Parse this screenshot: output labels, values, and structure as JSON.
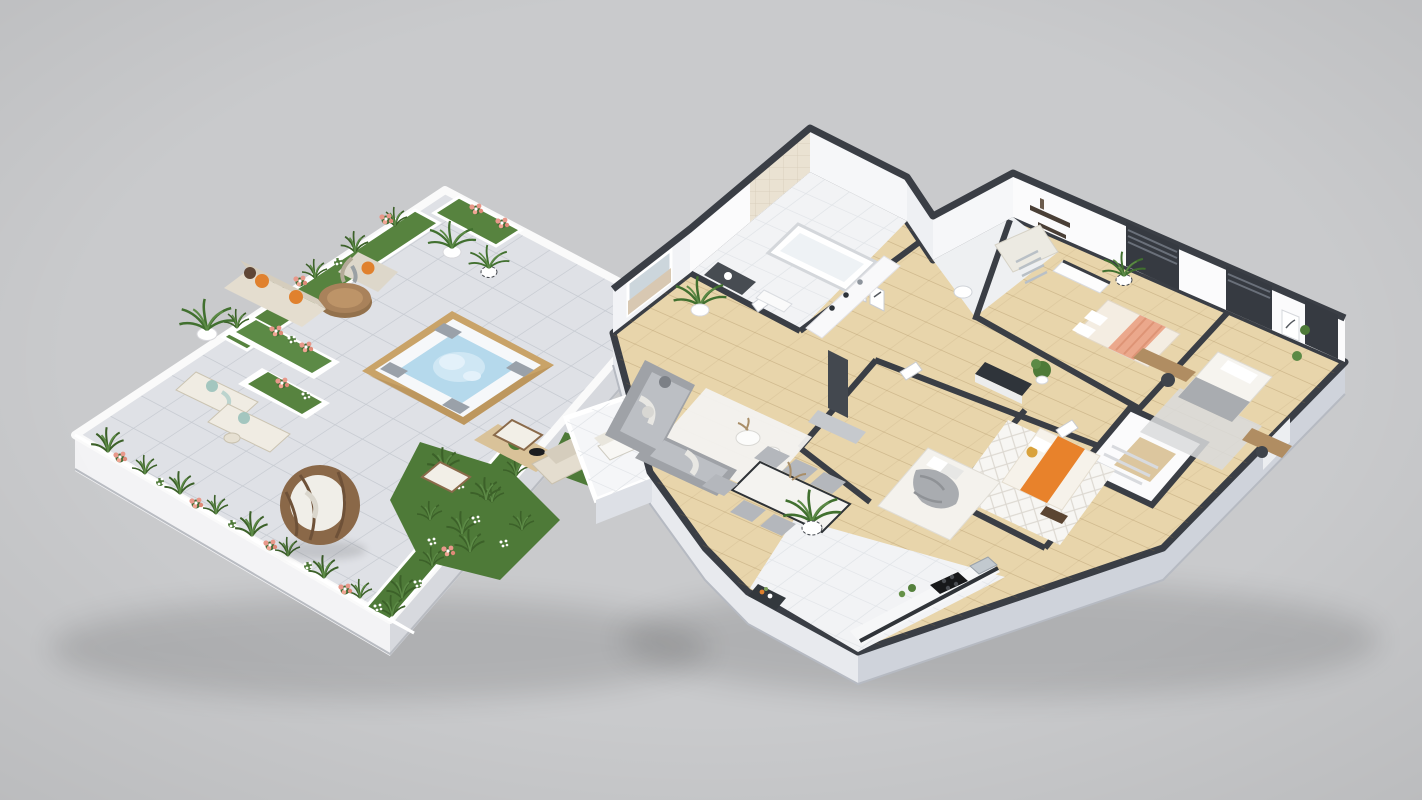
{
  "scene": {
    "type": "3d-isometric-floorplan-render",
    "description": "Two 3D isometric architectural renderings floating on a plain gray background: left, a rooftop terrace garden with a bubbling hot tub, planters of grasses and pink flowers, lounge furniture and a hanging egg chair; right, a cutaway furnished apartment floor plan with living room, kitchen, dining area, bathroom, shower room, three bedrooms, hallway, stairwell and a small balcony.",
    "background_color": "#c9cacc"
  },
  "palette": {
    "background": "#c9cacc",
    "wall_top": "#3a3e45",
    "wall_face_white": "#fbfbfc",
    "outer_face_light": "#e8eaee",
    "outer_face_dark": "#cfd3db",
    "wood_floor": "#e8d5ab",
    "white_tile": "#f2f3f5",
    "terrace_tile": "#dfe1e6",
    "terrace_slab_light": "#f3f3f5",
    "terrace_slab_dark": "#d7d9de",
    "greenery": "#4e7a38",
    "greenery_dark": "#3c6129",
    "flower_pink": "#e8988a",
    "flower_white": "#ffffff",
    "hot_tub_frame": "#c9a368",
    "hot_tub_rim": "#f6f8fa",
    "hot_tub_water": "#b5d9ec",
    "water_foam": "#e3f1fa",
    "headrest_gray": "#9aa1a9",
    "sofa_beige": "#e4ddcf",
    "sofa_back_beige": "#d5cdbd",
    "pillow_orange": "#e0812e",
    "pillow_brown": "#5f4636",
    "pillow_teal": "#a3c6bf",
    "rattan": "#8a6848",
    "cushion_white": "#f0eee8",
    "table_wood": "#a9825b",
    "table_tan": "#d9c299",
    "sofa_gray": "#9fa2a7",
    "cushion_gray": "#bcbfc4",
    "rug_white": "#f3f2f0",
    "bed_cream": "#f4ede2",
    "bed_peach": "#eba88c",
    "bed_orange": "#e8822b",
    "pillow_yellow": "#d9a23c",
    "blanket_gray": "#a9acb0",
    "counter_dark": "#2f343a",
    "media_wall": "#43484f",
    "window_dark": "#363a41",
    "tile_wall_beige": "#eae2d2",
    "stair_wood": "#dcc69e",
    "art_sand": "#d8c8b2",
    "art_sky": "#ccd6dc"
  },
  "terrace": {
    "label": "rooftop terrace",
    "items": [
      "hot tub with bubbling water and four gray headrests",
      "round wooden coffee table",
      "outdoor sofa with orange and brown pillows",
      "wicker armchair with orange cushion and gray throw",
      "two potted palms",
      "chevron planter pot",
      "two curved chaise lounges with teal pillows",
      "hanging rattan egg chair with white cushion",
      "low tan coffee table with topiary ball and black bowl",
      "two wooden folding chairs",
      "outdoor beige loveseat",
      "perimeter planters with tall grasses, pink and white flowers",
      "two raised white planter boxes",
      "green garden islands"
    ]
  },
  "apartment": {
    "label": "apartment floor plan",
    "rooms": [
      {
        "name": "living room",
        "furniture": [
          "gray corner sofa with throws",
          "white rug",
          "two round white coffee tables",
          "large framed beach artwork",
          "tall potted plant",
          "two small framed sketches",
          "dark media wall with console"
        ]
      },
      {
        "name": "dining area",
        "furniture": [
          "white stone dining table",
          "six gray upholstered chairs",
          "tall plant in chevron pot"
        ]
      },
      {
        "name": "kitchen",
        "furniture": [
          "white tiled floor",
          "counter with black cooktop",
          "steel sink",
          "dark shelf with jars",
          "small herb plants",
          "white cabinet run with bottles"
        ]
      },
      {
        "name": "bathroom",
        "furniture": [
          "bathtub",
          "beige tiled wall",
          "dark vanity cabinet"
        ]
      },
      {
        "name": "shower room",
        "furniture": [
          "tiled shower",
          "chrome towel ladder",
          "toilet"
        ]
      },
      {
        "name": "master bedroom",
        "furniture": [
          "double bed with cream and salmon bedding",
          "white dresser with dark top",
          "dark wall shelves with books",
          "plant in chevron pot",
          "wooden desk with chair",
          "two dark floor-to-ceiling windows"
        ]
      },
      {
        "name": "bedroom 2",
        "furniture": [
          "bed with white and gray bedding",
          "gray rug",
          "small desk",
          "framed botanical art",
          "wall plants",
          "dark window"
        ]
      },
      {
        "name": "bedroom 3",
        "furniture": [
          "bed with orange duvet and yellow pillow",
          "diamond patterned rug"
        ]
      },
      {
        "name": "bedroom 4",
        "furniture": [
          "bed with gray rumpled blanket"
        ]
      },
      {
        "name": "hallway",
        "furniture": [
          "dark-topped sideboard",
          "potted plant"
        ]
      },
      {
        "name": "stairwell",
        "furniture": [
          "white stair walls",
          "wood landing",
          "steps"
        ]
      },
      {
        "name": "balcony",
        "furniture": [
          "white tiled floor",
          "sun lounger",
          "white parapet"
        ]
      }
    ]
  }
}
